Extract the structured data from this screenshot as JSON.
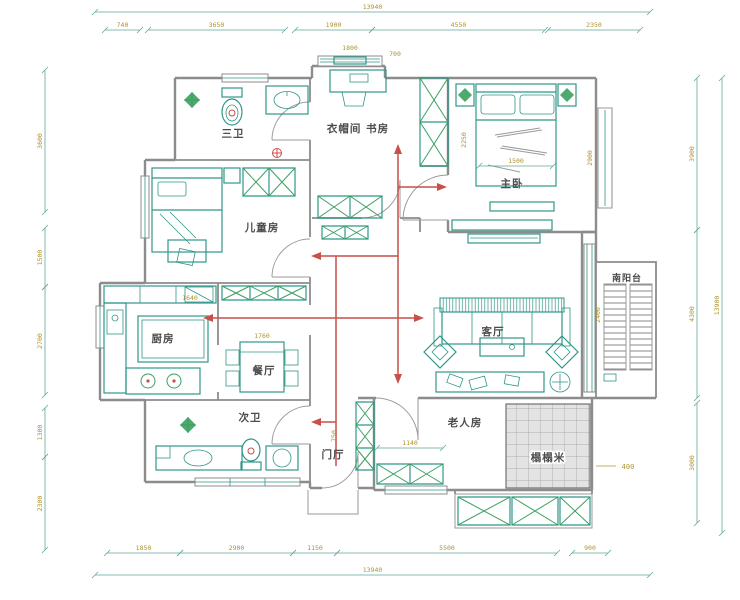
{
  "page": {
    "type": "architectural-floor-plan",
    "background": "#ffffff"
  },
  "colors": {
    "wall": "#8c8c8c",
    "furniture_teal": "#2f9688",
    "furniture_green": "#3ba05f",
    "dimension_line": "#5fa99b",
    "dimension_text": "#ad9430",
    "circulation_arrow": "#c94f4a",
    "room_label_text": "#4c4c4c",
    "tatami_fill": "#e3e3e3"
  },
  "rooms": [
    {
      "id": "bath3",
      "label": "三卫",
      "x": 233,
      "y": 137
    },
    {
      "id": "study",
      "label": "衣帽间 书房",
      "x": 358,
      "y": 132
    },
    {
      "id": "master",
      "label": "主卧",
      "x": 512,
      "y": 187
    },
    {
      "id": "kids",
      "label": "儿童房",
      "x": 262,
      "y": 231
    },
    {
      "id": "kitchen",
      "label": "厨房",
      "x": 163,
      "y": 342
    },
    {
      "id": "dining",
      "label": "餐厅",
      "x": 264,
      "y": 374
    },
    {
      "id": "living",
      "label": "客厅",
      "x": 493,
      "y": 335
    },
    {
      "id": "bath2",
      "label": "次卫",
      "x": 250,
      "y": 421
    },
    {
      "id": "foyer",
      "label": "门厅",
      "x": 333,
      "y": 458
    },
    {
      "id": "elder",
      "label": "老人房",
      "x": 465,
      "y": 426
    },
    {
      "id": "tatami",
      "label": "榻榻米",
      "x": 548,
      "y": 461
    },
    {
      "id": "balcony",
      "label": "南阳台",
      "x": 627,
      "y": 281
    }
  ],
  "dimensions": {
    "segments": [
      {
        "x1": 95,
        "y1": 12,
        "x2": 650,
        "y2": 12,
        "label": "13940"
      },
      {
        "x1": 105,
        "y1": 30,
        "x2": 140,
        "y2": 30,
        "label": "740"
      },
      {
        "x1": 148,
        "y1": 30,
        "x2": 285,
        "y2": 30,
        "label": "3650"
      },
      {
        "x1": 295,
        "y1": 30,
        "x2": 372,
        "y2": 30,
        "label": "1900"
      },
      {
        "x1": 372,
        "y1": 30,
        "x2": 545,
        "y2": 30,
        "label": "4550"
      },
      {
        "x1": 548,
        "y1": 30,
        "x2": 640,
        "y2": 30,
        "label": "2350"
      },
      {
        "x1": 107,
        "y1": 553,
        "x2": 180,
        "y2": 553,
        "label": "1850"
      },
      {
        "x1": 180,
        "y1": 553,
        "x2": 293,
        "y2": 553,
        "label": "2900"
      },
      {
        "x1": 293,
        "y1": 553,
        "x2": 337,
        "y2": 553,
        "label": "1150"
      },
      {
        "x1": 337,
        "y1": 553,
        "x2": 557,
        "y2": 553,
        "label": "5500"
      },
      {
        "x1": 572,
        "y1": 553,
        "x2": 608,
        "y2": 553,
        "label": "900"
      },
      {
        "x1": 95,
        "y1": 575,
        "x2": 650,
        "y2": 575,
        "label": "13940"
      },
      {
        "x1": 45,
        "y1": 70,
        "x2": 45,
        "y2": 212,
        "label": "3600",
        "rot": 1
      },
      {
        "x1": 45,
        "y1": 228,
        "x2": 45,
        "y2": 287,
        "label": "1500",
        "rot": 1
      },
      {
        "x1": 45,
        "y1": 287,
        "x2": 45,
        "y2": 395,
        "label": "2700",
        "rot": 1
      },
      {
        "x1": 45,
        "y1": 408,
        "x2": 45,
        "y2": 457,
        "label": "1300",
        "rot": 1
      },
      {
        "x1": 45,
        "y1": 457,
        "x2": 45,
        "y2": 550,
        "label": "2300",
        "rot": 1
      },
      {
        "x1": 697,
        "y1": 78,
        "x2": 697,
        "y2": 230,
        "label": "3900",
        "rot": 1
      },
      {
        "x1": 697,
        "y1": 230,
        "x2": 697,
        "y2": 398,
        "label": "4300",
        "rot": 1
      },
      {
        "x1": 697,
        "y1": 403,
        "x2": 697,
        "y2": 523,
        "label": "3000",
        "rot": 1
      },
      {
        "x1": 722,
        "y1": 78,
        "x2": 722,
        "y2": 533,
        "label": "13900",
        "rot": 1
      },
      {
        "x1": 479,
        "y1": 166,
        "x2": 553,
        "y2": 166,
        "label": "1500"
      },
      {
        "x1": 377,
        "y1": 448,
        "x2": 443,
        "y2": 448,
        "label": "1140"
      }
    ],
    "interior": [
      {
        "label": "1800",
        "x": 350,
        "y": 50
      },
      {
        "label": "700",
        "x": 395,
        "y": 56
      },
      {
        "label": "2900",
        "x": 592,
        "y": 158,
        "rot": 1
      },
      {
        "label": "2250",
        "x": 466,
        "y": 140,
        "rot": 1
      },
      {
        "label": "1640",
        "x": 190,
        "y": 300
      },
      {
        "label": "1760",
        "x": 262,
        "y": 338
      },
      {
        "label": "750",
        "x": 336,
        "y": 436,
        "rot": 1
      },
      {
        "label": "2400",
        "x": 600,
        "y": 315,
        "rot": 1
      }
    ]
  },
  "annotations": [
    {
      "label": "400",
      "x": 628,
      "y": 469
    }
  ]
}
